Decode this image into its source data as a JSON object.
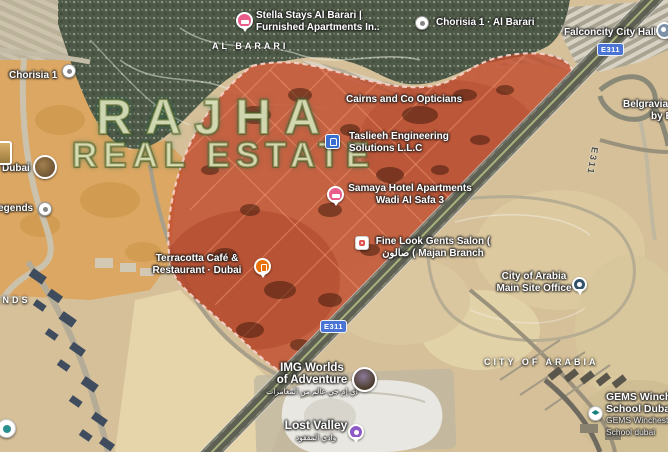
{
  "watermark": {
    "line1": "RAJHA",
    "line2": "REAL ESTATE"
  },
  "area_labels": {
    "al_barari": "AL BARARI",
    "city_of_arabia": "CITY OF ARABIA",
    "legends": "LEGENDS"
  },
  "roads": {
    "shield_top": "E311",
    "shield_bottom": "E311",
    "road_name": "E311"
  },
  "places": {
    "stella": {
      "line1": "Stella Stays Al Barari |",
      "line2": "Furnished Apartments In.."
    },
    "chorisia_al_barari": {
      "line1": "Chorisia 1 · Al Barari"
    },
    "falconcity": {
      "line1": "Falconcity City Hall"
    },
    "belgravia": {
      "line1": "Belgravia",
      "line2": "by E"
    },
    "chorisia_1": {
      "line1": "Chorisia 1"
    },
    "cairns": {
      "line1": "Cairns and Co Opticians"
    },
    "taslieeh": {
      "line1": "Taslieeh Engineering",
      "line2": "Solutions L.L.C"
    },
    "samaya": {
      "line1": "Samaya Hotel Apartments",
      "line2": "Wadi Al Safa 3"
    },
    "fine_look": {
      "line1": "Fine Look Gents Salon (",
      "line2": "صالون ( Majan Branch"
    },
    "terracotta": {
      "line1": "Terracotta Café &",
      "line2": "Restaurant · Dubai"
    },
    "coa_office": {
      "line1": "City of Arabia",
      "line2": "Main Site Office"
    },
    "img_worlds": {
      "line1": "IMG Worlds",
      "line2": "of Adventure",
      "line3": "آي إم جي عالم من المغامرات"
    },
    "lost_valley": {
      "line1": "Lost Valley",
      "line2": "وادي المفقود"
    },
    "gems": {
      "line1": "GEMS Winchester",
      "line2": "School Dubai",
      "line3": "GEMS Winchester",
      "line4": "School dubai"
    },
    "dubai": {
      "line1": "Dubai"
    },
    "legends_poi": {
      "line1": "Legends"
    }
  },
  "colors": {
    "region_red": "#c14a2c",
    "hotel_pink": "#e85d8a",
    "restaurant_orange": "#e8710a",
    "office_navy": "#33536b",
    "theme_purple": "#8e5bc6",
    "school_teal": "#17807a",
    "badge_blue": "#3a6fd0",
    "shield_blue": "#4a74d4",
    "watermark_cream": "#fdf7cd"
  }
}
